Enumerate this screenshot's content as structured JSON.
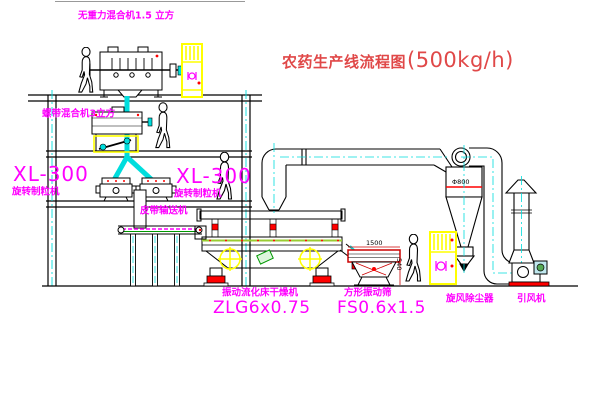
{
  "title": {
    "zh": "农药生产线流程图",
    "capacity": "(500kg/h)"
  },
  "equipment_labels": {
    "top_mixer": "无重力混合机1.5 立方",
    "second_mixer": "螺带混合机3立方",
    "granulator_left_model": "XL-300",
    "granulator_left_name": "旋转制粒机",
    "granulator_right_model": "XL-300",
    "granulator_right_name": "旋转制粒机",
    "belt_conveyor": "皮带输送机",
    "dryer_name": "振动流化床干燥机",
    "dryer_model": "ZLG6x0.75",
    "sieve_name": "方形振动筛",
    "sieve_model": "FS0.6x1.5",
    "cyclone_name": "旋风除尘器",
    "fan_name": "引风机"
  },
  "dimensions": {
    "sieve_width": "1500",
    "sieve_height": "540",
    "cyclone_diameter": "Φ800"
  },
  "colors": {
    "label_magenta": "#ff00ff",
    "title_red": "#e04848",
    "centerline_cyan": "#00dddd",
    "cabinet_yellow": "#ffff00",
    "accent_red": "#ff0000",
    "machine_green": "#009900",
    "line_black": "#000000"
  }
}
